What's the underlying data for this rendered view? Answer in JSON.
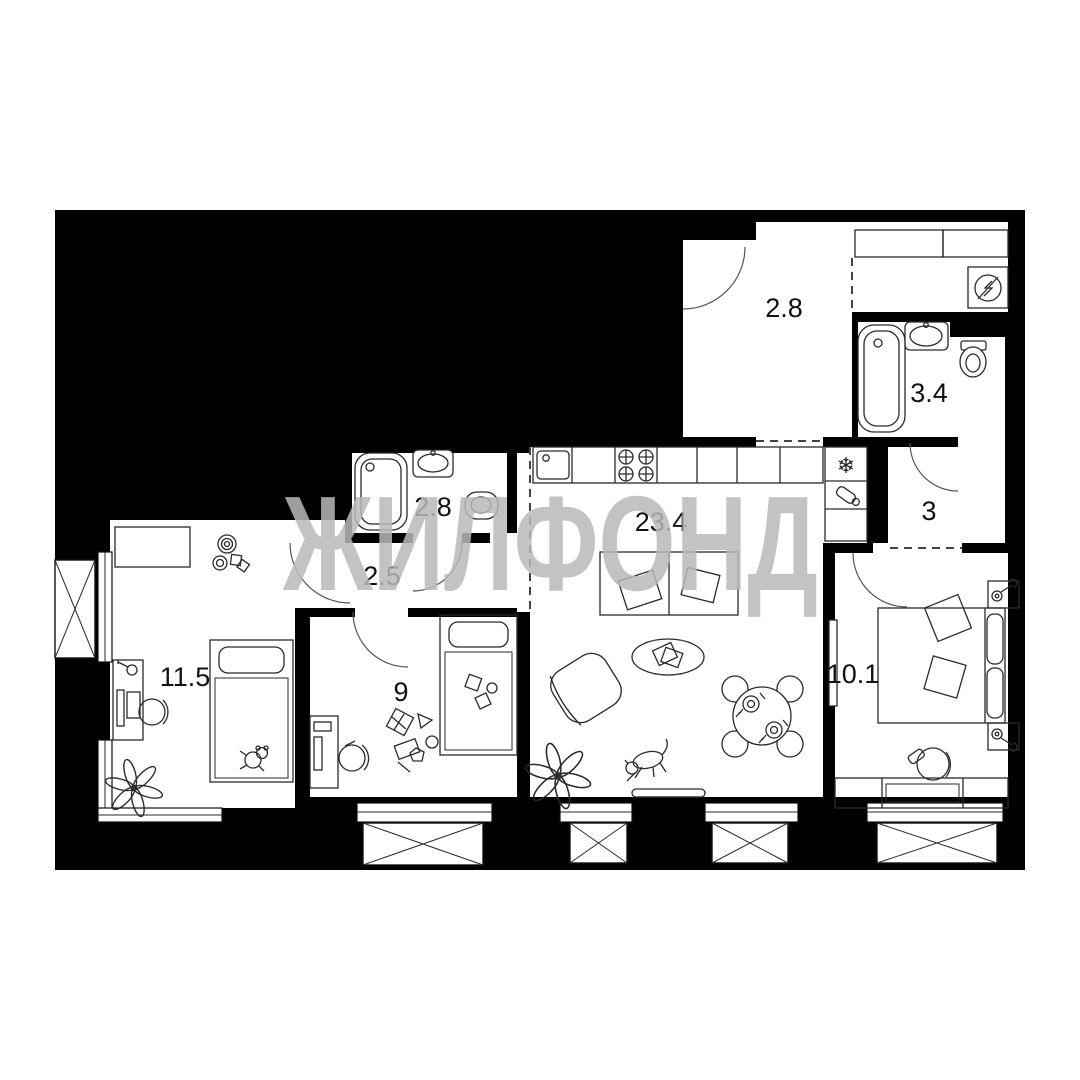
{
  "watermark": "ЖИЛФОНД",
  "rooms": [
    {
      "name": "entry-hall",
      "area": "2.8"
    },
    {
      "name": "bathroom-main",
      "area": "3.4"
    },
    {
      "name": "corridor",
      "area": "3"
    },
    {
      "name": "bathroom-second",
      "area": "2.8"
    },
    {
      "name": "hallway-inner",
      "area": "2.5"
    },
    {
      "name": "kitchen-living-room",
      "area": "23.4"
    },
    {
      "name": "bedroom-left",
      "area": "11.5"
    },
    {
      "name": "bedroom-middle",
      "area": "9"
    },
    {
      "name": "bedroom-right",
      "area": "10.1"
    }
  ],
  "icons": {
    "fridge_snowflake": "❄"
  },
  "colors": {
    "walls": "#000000",
    "watermark": "#b9b9b9",
    "label_text": "#111111"
  }
}
